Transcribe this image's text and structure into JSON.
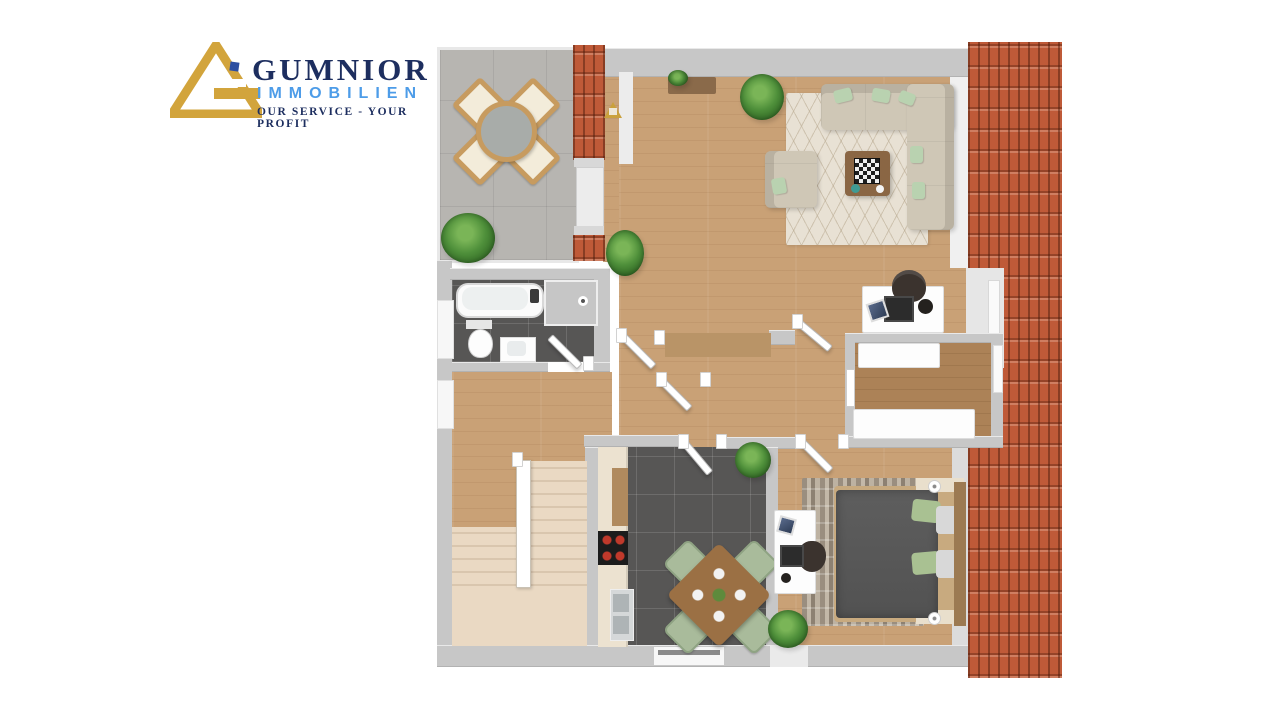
{
  "logo": {
    "brand": "GUMNIOR",
    "subtitle": "IMMOBILIEN",
    "tagline": "OUR SERVICE - YOUR PROFIT",
    "colors": {
      "gold": "#d2a43c",
      "navy": "#1d2e5f",
      "light_blue": "#4d9ce8"
    }
  },
  "scene": {
    "type": "3D floor plan, top-down rendering",
    "rooms": [
      "terrace",
      "living-room",
      "home-office-nook",
      "dressing-room",
      "bathroom",
      "hallway",
      "kitchen",
      "bedroom",
      "staircase"
    ]
  },
  "palette": {
    "background": "#ffffff",
    "wall_gray": "#c7c7c7",
    "wall_white": "#efefef",
    "wood_floor": "#c9a176",
    "wood_dark": "#ac8257",
    "terrace_tile": "#b7b5b1",
    "roof_tile": "#bf5a38",
    "roof_tile_dark": "#8c3d26",
    "dark_floor_tile": "#575655",
    "stairs_carpet": "#ead9c3",
    "sofa_beige": "#cfc7b6",
    "living_rug_cream": "#e8e1d4",
    "bedroom_rug_taupe": "#a89c8d",
    "bed_duvet_gray": "#575757",
    "pillow_green": "#a9c192",
    "kitchen_chair_sage": "#a9bb9b",
    "table_wood": "#9b7044",
    "counter_cream": "#ece2d0",
    "plant_green": "#4e8f3a"
  }
}
